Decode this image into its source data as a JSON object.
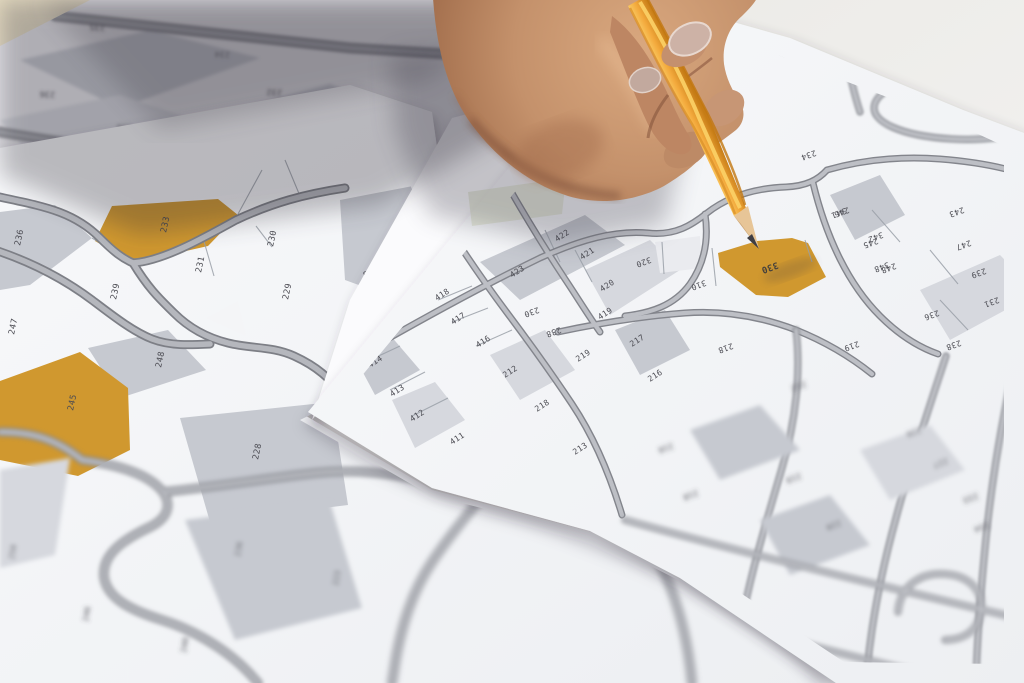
{
  "scene_title": "Cadastral parcel maps with pencil",
  "colors": {
    "parcel_highlight": "#d0982f",
    "pencil_body": "#f2a43c",
    "pencil_wood": "#e7c597",
    "pencil_lead": "#3f3e44",
    "road_fill": "#b5b7bd",
    "road_casing": "#7d7f86",
    "paper": "#f4f5f7",
    "parcel_gray": "#c6c9d0",
    "table": "#e9e0c8",
    "label_ink": "#4b4b52",
    "sticky_note": "#dce1ca",
    "skin": "#c4916b"
  },
  "highlighted_parcels": [
    "233",
    "245",
    "330"
  ],
  "maps": {
    "back": {
      "rot": 182,
      "size": 8,
      "labels": [
        {
          "t": "235",
          "x": 105,
          "y": 25
        },
        {
          "t": "234",
          "x": 230,
          "y": 52
        },
        {
          "t": "236",
          "x": 55,
          "y": 92
        },
        {
          "t": "232",
          "x": 282,
          "y": 90
        },
        {
          "t": "238",
          "x": 132,
          "y": 125
        },
        {
          "t": "231",
          "x": 343,
          "y": 127
        }
      ]
    },
    "left": {
      "rot": -78,
      "size": 8.5,
      "labels": [
        {
          "t": "236",
          "x": 20,
          "y": 246
        },
        {
          "t": "233",
          "x": 166,
          "y": 233
        },
        {
          "t": "230",
          "x": 273,
          "y": 247
        },
        {
          "t": "231",
          "x": 201,
          "y": 273
        },
        {
          "t": "239",
          "x": 116,
          "y": 300
        },
        {
          "t": "229",
          "x": 288,
          "y": 300
        },
        {
          "t": "247",
          "x": 14,
          "y": 335
        },
        {
          "t": "248",
          "x": 161,
          "y": 368
        },
        {
          "t": "245",
          "x": 73,
          "y": 411
        },
        {
          "t": "228",
          "x": 258,
          "y": 460
        },
        {
          "t": "222",
          "x": 445,
          "y": 237,
          "r": 165
        },
        {
          "t": "228",
          "x": 378,
          "y": 268,
          "r": 165
        }
      ]
    },
    "leftbottom": {
      "rot": -80,
      "size": 8,
      "labels": [
        {
          "t": "250",
          "x": 14,
          "y": 560
        },
        {
          "t": "246",
          "x": 88,
          "y": 622
        },
        {
          "t": "240",
          "x": 186,
          "y": 653
        },
        {
          "t": "236",
          "x": 240,
          "y": 557
        },
        {
          "t": "223",
          "x": 338,
          "y": 586
        }
      ]
    },
    "top": {
      "rot": -33,
      "size": 8,
      "labels": [
        {
          "t": "418",
          "x": 437,
          "y": 301
        },
        {
          "t": "417",
          "x": 453,
          "y": 325
        },
        {
          "t": "416",
          "x": 478,
          "y": 348
        },
        {
          "t": "415",
          "x": 358,
          "y": 346
        },
        {
          "t": "414",
          "x": 370,
          "y": 368
        },
        {
          "t": "413",
          "x": 392,
          "y": 397
        },
        {
          "t": "412",
          "x": 412,
          "y": 422
        },
        {
          "t": "411",
          "x": 452,
          "y": 445
        },
        {
          "t": "423",
          "x": 512,
          "y": 278
        },
        {
          "t": "422",
          "x": 557,
          "y": 242
        },
        {
          "t": "421",
          "x": 582,
          "y": 260
        },
        {
          "t": "420",
          "x": 602,
          "y": 292
        },
        {
          "t": "419",
          "x": 600,
          "y": 320
        },
        {
          "t": "212",
          "x": 505,
          "y": 378
        },
        {
          "t": "218",
          "x": 537,
          "y": 412
        },
        {
          "t": "219",
          "x": 578,
          "y": 362
        },
        {
          "t": "217",
          "x": 632,
          "y": 347
        },
        {
          "t": "216",
          "x": 650,
          "y": 382
        },
        {
          "t": "213",
          "x": 575,
          "y": 455
        },
        {
          "t": "230",
          "x": 538,
          "y": 307,
          "r": 160
        },
        {
          "t": "238",
          "x": 560,
          "y": 327,
          "r": 160
        }
      ]
    },
    "pencil": {
      "rot": 160,
      "size": 8,
      "labels": [
        {
          "t": "330",
          "x": 777,
          "y": 262,
          "s": 9,
          "bold": true
        },
        {
          "t": "320",
          "x": 650,
          "y": 257
        },
        {
          "t": "310",
          "x": 705,
          "y": 280
        },
        {
          "t": "341",
          "x": 845,
          "y": 208
        },
        {
          "t": "342",
          "x": 882,
          "y": 232
        },
        {
          "t": "348",
          "x": 888,
          "y": 262
        },
        {
          "t": "218",
          "x": 732,
          "y": 343
        },
        {
          "t": "219",
          "x": 858,
          "y": 341
        },
        {
          "t": "234",
          "x": 815,
          "y": 150
        }
      ]
    },
    "right": {
      "rot": 160,
      "size": 8,
      "labels": [
        {
          "t": "246",
          "x": 848,
          "y": 207
        },
        {
          "t": "245",
          "x": 877,
          "y": 238
        },
        {
          "t": "248",
          "x": 895,
          "y": 263
        },
        {
          "t": "243",
          "x": 963,
          "y": 207
        },
        {
          "t": "247",
          "x": 970,
          "y": 240
        },
        {
          "t": "239",
          "x": 985,
          "y": 268
        },
        {
          "t": "231",
          "x": 998,
          "y": 297
        },
        {
          "t": "236",
          "x": 938,
          "y": 310
        },
        {
          "t": "238",
          "x": 960,
          "y": 340
        }
      ]
    },
    "bottomright": {
      "rot": 160,
      "size": 8,
      "labels": [
        {
          "t": "212",
          "x": 805,
          "y": 381
        },
        {
          "t": "216",
          "x": 672,
          "y": 443
        },
        {
          "t": "218",
          "x": 697,
          "y": 490
        },
        {
          "t": "219",
          "x": 800,
          "y": 473
        },
        {
          "t": "220",
          "x": 840,
          "y": 520
        },
        {
          "t": "226",
          "x": 920,
          "y": 427
        },
        {
          "t": "227",
          "x": 947,
          "y": 458
        },
        {
          "t": "233",
          "x": 977,
          "y": 493
        },
        {
          "t": "234",
          "x": 988,
          "y": 522
        }
      ]
    }
  }
}
